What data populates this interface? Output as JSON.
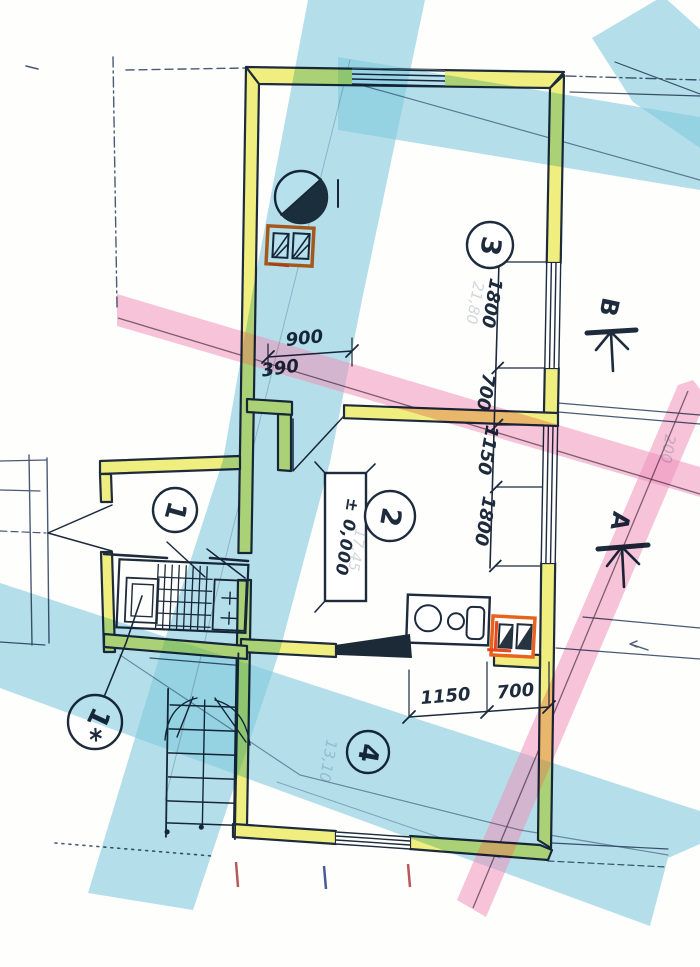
{
  "rooms": [
    {
      "label": "3",
      "area_note": "21,80"
    },
    {
      "label": "2",
      "area_note": "17,45"
    },
    {
      "label": "1",
      "area_note": ""
    },
    {
      "label": "4",
      "area_note": "13,10"
    },
    {
      "label": "1*",
      "area_note": ""
    }
  ],
  "dimensions": {
    "door_width": "900",
    "door_offset": "390",
    "right_chain": [
      "1800",
      "700",
      "1150",
      "1800"
    ],
    "bottom_chain": [
      "1150",
      "700"
    ],
    "faint_note": "200"
  },
  "level_marker": "± 0,000",
  "benchmarks": [
    {
      "label": "B"
    },
    {
      "label": "A"
    }
  ],
  "colors": {
    "ink": "#1d2b3c",
    "pencil": "#4a5a74",
    "wall": "#f0ee7e",
    "chimney": "#e8641e",
    "red": "#e84818",
    "cyan": "#7fc9de",
    "pink": "#f093bd",
    "faint": "#6b7a93"
  }
}
